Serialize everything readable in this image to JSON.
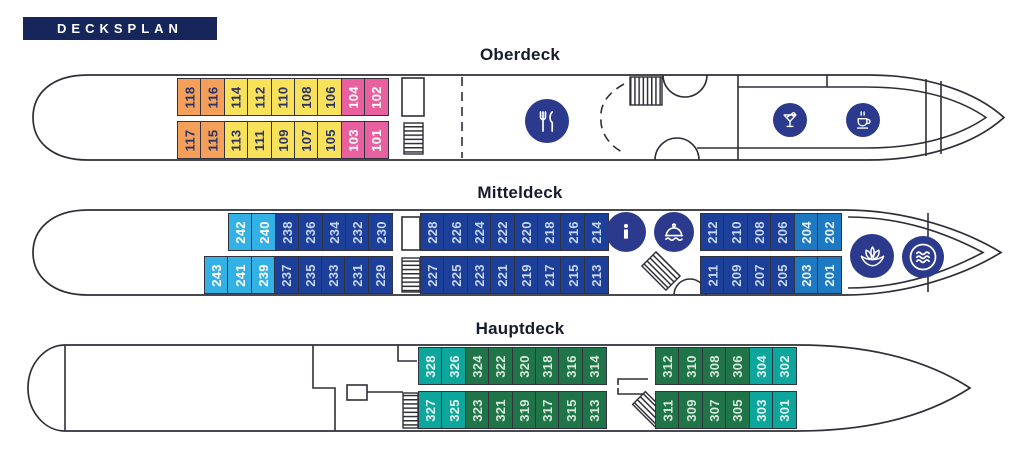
{
  "header": {
    "label": "DECKSPLAN"
  },
  "palette": {
    "header_bg": "#16265a",
    "title_color": "#171b2e",
    "hull_line": "#2f2f38",
    "cabin_border": "#33333f",
    "icon_circle": "#2b3a8c",
    "icon_glyph": "#ffffff"
  },
  "cabin_colors": {
    "orange": "#f4a05b",
    "yellow": "#f8e15b",
    "pink": "#e9609f",
    "cyan": "#33b1e4",
    "navy": "#1c3f99",
    "blue": "#1d79c1",
    "teal": "#0ca69c",
    "green": "#1f7448"
  },
  "cabin_text": {
    "orange": "#2b3365",
    "yellow": "#2b3365",
    "pink": "#ffffff",
    "cyan": "#ffffff",
    "navy": "#c9d6f2",
    "blue": "#eaf3fb",
    "teal": "#e3f4ef",
    "green": "#d6e8d9"
  },
  "decks": [
    {
      "id": "oberdeck",
      "title": "Oberdeck",
      "icons": [
        "restaurant-icon",
        "cocktail-icon",
        "coffee-icon"
      ],
      "runs": {
        "top": [
          {
            "n": "118",
            "c": "orange"
          },
          {
            "n": "116",
            "c": "orange"
          },
          {
            "n": "114",
            "c": "yellow"
          },
          {
            "n": "112",
            "c": "yellow"
          },
          {
            "n": "110",
            "c": "yellow"
          },
          {
            "n": "108",
            "c": "yellow"
          },
          {
            "n": "106",
            "c": "yellow"
          },
          {
            "n": "104",
            "c": "pink"
          },
          {
            "n": "102",
            "c": "pink"
          }
        ],
        "bottom": [
          {
            "n": "117",
            "c": "orange"
          },
          {
            "n": "115",
            "c": "orange"
          },
          {
            "n": "113",
            "c": "yellow"
          },
          {
            "n": "111",
            "c": "yellow"
          },
          {
            "n": "109",
            "c": "yellow"
          },
          {
            "n": "107",
            "c": "yellow"
          },
          {
            "n": "105",
            "c": "yellow"
          },
          {
            "n": "103",
            "c": "pink"
          },
          {
            "n": "101",
            "c": "pink"
          }
        ]
      }
    },
    {
      "id": "mitteldeck",
      "title": "Mitteldeck",
      "icons": [
        "info-icon",
        "service-bell-icon",
        "spa-lotus-icon",
        "pool-waves-icon"
      ],
      "runs": {
        "top1": [
          {
            "n": "242",
            "c": "cyan"
          },
          {
            "n": "240",
            "c": "cyan"
          },
          {
            "n": "238",
            "c": "navy"
          },
          {
            "n": "236",
            "c": "navy"
          },
          {
            "n": "234",
            "c": "navy"
          },
          {
            "n": "232",
            "c": "navy"
          },
          {
            "n": "230",
            "c": "navy"
          }
        ],
        "top2": [
          {
            "n": "228",
            "c": "navy"
          },
          {
            "n": "226",
            "c": "navy"
          },
          {
            "n": "224",
            "c": "navy"
          },
          {
            "n": "222",
            "c": "navy"
          },
          {
            "n": "220",
            "c": "navy"
          },
          {
            "n": "218",
            "c": "navy"
          },
          {
            "n": "216",
            "c": "navy"
          },
          {
            "n": "214",
            "c": "navy"
          }
        ],
        "top3": [
          {
            "n": "212",
            "c": "navy"
          },
          {
            "n": "210",
            "c": "navy"
          },
          {
            "n": "208",
            "c": "navy"
          },
          {
            "n": "206",
            "c": "navy"
          },
          {
            "n": "204",
            "c": "blue"
          },
          {
            "n": "202",
            "c": "blue"
          }
        ],
        "bottom1": [
          {
            "n": "243",
            "c": "cyan"
          },
          {
            "n": "241",
            "c": "cyan"
          },
          {
            "n": "239",
            "c": "cyan"
          },
          {
            "n": "237",
            "c": "navy"
          },
          {
            "n": "235",
            "c": "navy"
          },
          {
            "n": "233",
            "c": "navy"
          },
          {
            "n": "231",
            "c": "navy"
          },
          {
            "n": "229",
            "c": "navy"
          }
        ],
        "bottom2": [
          {
            "n": "227",
            "c": "navy"
          },
          {
            "n": "225",
            "c": "navy"
          },
          {
            "n": "223",
            "c": "navy"
          },
          {
            "n": "221",
            "c": "navy"
          },
          {
            "n": "219",
            "c": "navy"
          },
          {
            "n": "217",
            "c": "navy"
          },
          {
            "n": "215",
            "c": "navy"
          },
          {
            "n": "213",
            "c": "navy"
          }
        ],
        "bottom3": [
          {
            "n": "211",
            "c": "navy"
          },
          {
            "n": "209",
            "c": "navy"
          },
          {
            "n": "207",
            "c": "navy"
          },
          {
            "n": "205",
            "c": "navy"
          },
          {
            "n": "203",
            "c": "blue"
          },
          {
            "n": "201",
            "c": "blue"
          }
        ]
      }
    },
    {
      "id": "hauptdeck",
      "title": "Hauptdeck",
      "icons": [],
      "runs": {
        "top1": [
          {
            "n": "328",
            "c": "teal"
          },
          {
            "n": "326",
            "c": "teal"
          },
          {
            "n": "324",
            "c": "green"
          },
          {
            "n": "322",
            "c": "green"
          },
          {
            "n": "320",
            "c": "green"
          },
          {
            "n": "318",
            "c": "green"
          },
          {
            "n": "316",
            "c": "green"
          },
          {
            "n": "314",
            "c": "green"
          }
        ],
        "top2": [
          {
            "n": "312",
            "c": "green"
          },
          {
            "n": "310",
            "c": "green"
          },
          {
            "n": "308",
            "c": "green"
          },
          {
            "n": "306",
            "c": "green"
          },
          {
            "n": "304",
            "c": "teal"
          },
          {
            "n": "302",
            "c": "teal"
          }
        ],
        "bottom1": [
          {
            "n": "327",
            "c": "teal"
          },
          {
            "n": "325",
            "c": "teal"
          },
          {
            "n": "323",
            "c": "green"
          },
          {
            "n": "321",
            "c": "green"
          },
          {
            "n": "319",
            "c": "green"
          },
          {
            "n": "317",
            "c": "green"
          },
          {
            "n": "315",
            "c": "green"
          },
          {
            "n": "313",
            "c": "green"
          }
        ],
        "bottom2": [
          {
            "n": "311",
            "c": "green"
          },
          {
            "n": "309",
            "c": "green"
          },
          {
            "n": "307",
            "c": "green"
          },
          {
            "n": "305",
            "c": "green"
          },
          {
            "n": "303",
            "c": "teal"
          },
          {
            "n": "301",
            "c": "teal"
          }
        ]
      }
    }
  ]
}
